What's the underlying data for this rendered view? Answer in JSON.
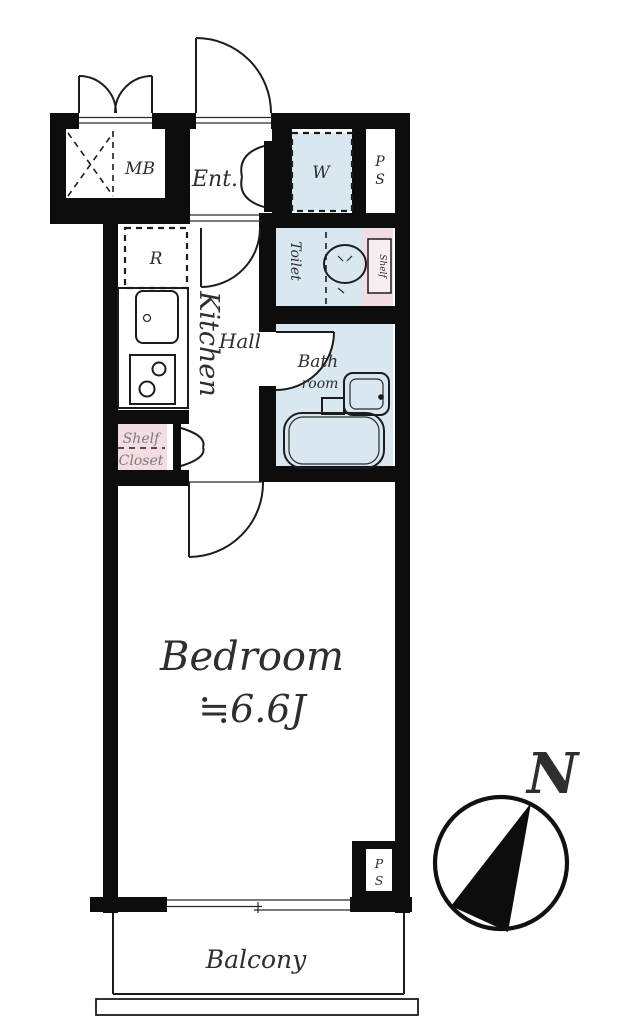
{
  "colors": {
    "wall": "#0d0d0d",
    "wet_area_blue": "#d9e7f0",
    "closet_pink": "#f3dce2",
    "line": "#1c1c1c",
    "text": "#2e2e2e"
  },
  "floorplan": {
    "rooms": {
      "mb": "MB",
      "entrance": "Ent.",
      "washer": "W",
      "pipe_space_top": {
        "line1": "P",
        "line2": "S"
      },
      "refrigerator": "R",
      "kitchen": "Kitchen",
      "hall": "Hall",
      "toilet": "Toilet",
      "toilet_shelf": "Shelf",
      "bathroom": {
        "line1": "Bath",
        "line2": "room"
      },
      "shelf_closet": {
        "line1": "Shelf",
        "line2": "Closet"
      },
      "bedroom": {
        "name": "Bedroom",
        "size": "≒6.6J"
      },
      "pipe_space_bottom": {
        "line1": "P",
        "line2": "S"
      },
      "balcony": "Balcony"
    },
    "compass": {
      "label": "N"
    }
  }
}
